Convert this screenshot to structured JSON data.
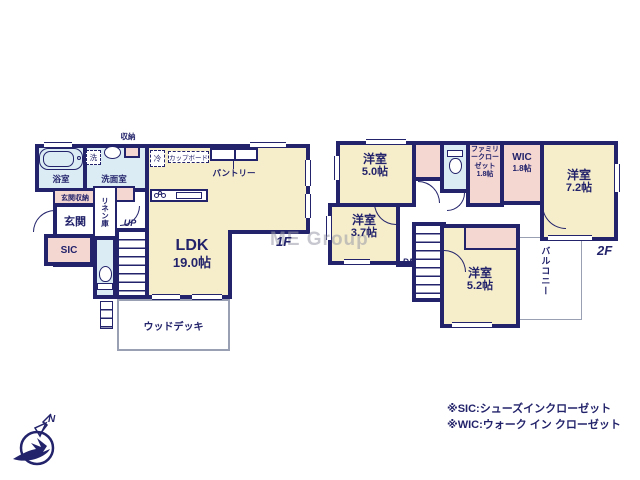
{
  "colors": {
    "wall": "#23236b",
    "room_fill": "#f6eecb",
    "closet_fill": "#f5d7d2",
    "wet_fill": "#dbecf4",
    "deck_outline": "#9aa0b4",
    "watermark_gray": "#9b9baa"
  },
  "watermark": "ME Group",
  "compass": {
    "north": "N"
  },
  "floor1": {
    "label": "1F",
    "ldk": {
      "name": "LDK",
      "size": "19.0帖"
    },
    "bathroom": "浴室",
    "washroom": "洗面室",
    "laundry": "洗",
    "storage": "収納",
    "fridge": "冷",
    "cupboard": "カップボード",
    "pantry": "パントリー",
    "entrance": "玄関",
    "entrance_storage": "玄関収納",
    "linen_closet": "リネン庫",
    "shoes_in_closet": "SIC",
    "stairs_up": "UP",
    "wood_deck": "ウッドデッキ"
  },
  "floor2": {
    "label": "2F",
    "room_5_0": {
      "name": "洋室",
      "size": "5.0帖"
    },
    "room_3_7": {
      "name": "洋室",
      "size": "3.7帖"
    },
    "room_7_2": {
      "name": "洋室",
      "size": "7.2帖"
    },
    "room_5_2": {
      "name": "洋室",
      "size": "5.2帖"
    },
    "family_closet": {
      "name": "ファミリークローゼット",
      "size": "1.8帖"
    },
    "wic": {
      "name": "WIC",
      "size": "1.8帖"
    },
    "balcony": "バルコニー",
    "stairs_down": "DN"
  },
  "notes": {
    "sic": "※SIC:シューズインクローゼット",
    "wic": "※WIC:ウォーク イン クローゼット"
  }
}
